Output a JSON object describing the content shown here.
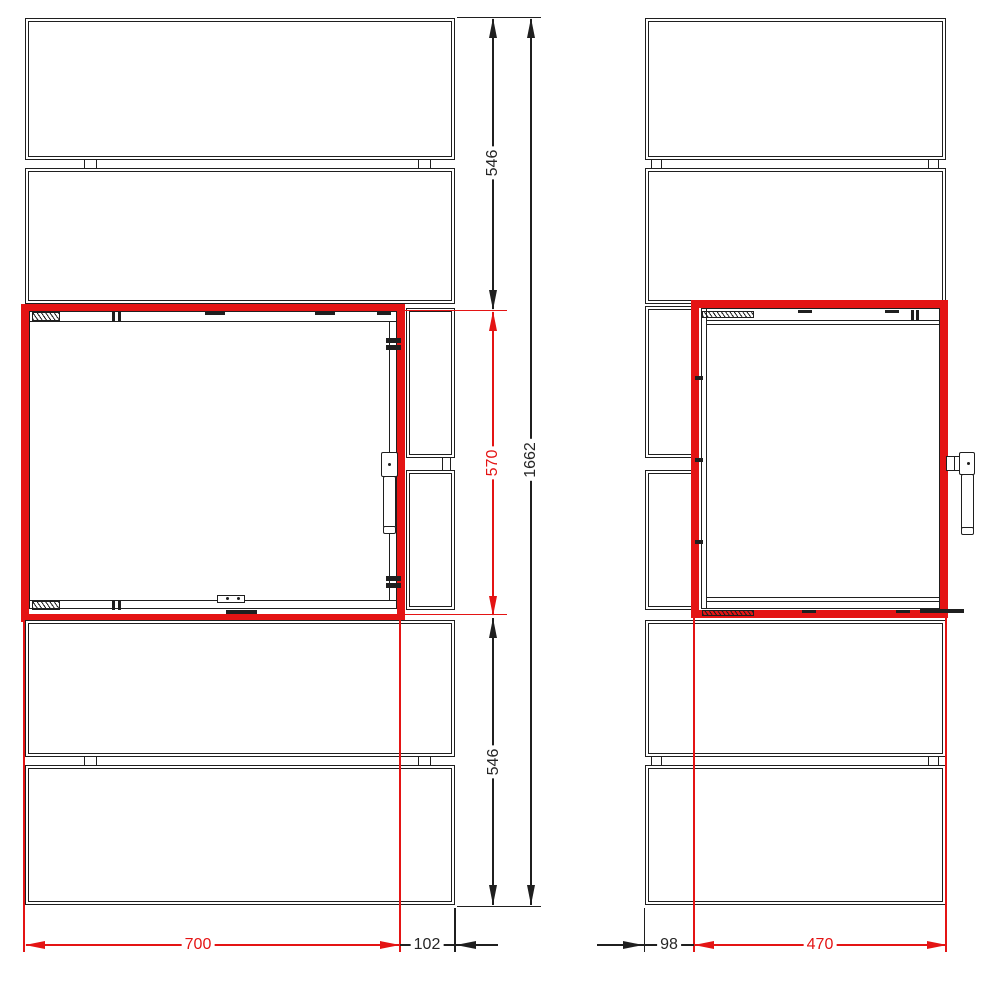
{
  "dimensions": {
    "front_view": {
      "upper_section_height": "546",
      "door_height": "570",
      "total_height": "1662",
      "lower_section_height": "546",
      "door_width": "700",
      "right_offset": "102"
    },
    "side_view": {
      "rear_offset": "98",
      "door_depth": "470"
    }
  },
  "colors": {
    "highlight_red": "#e41414",
    "line_black": "#1f1f1f",
    "dim_text_black": "#262626",
    "background": "#ffffff"
  }
}
